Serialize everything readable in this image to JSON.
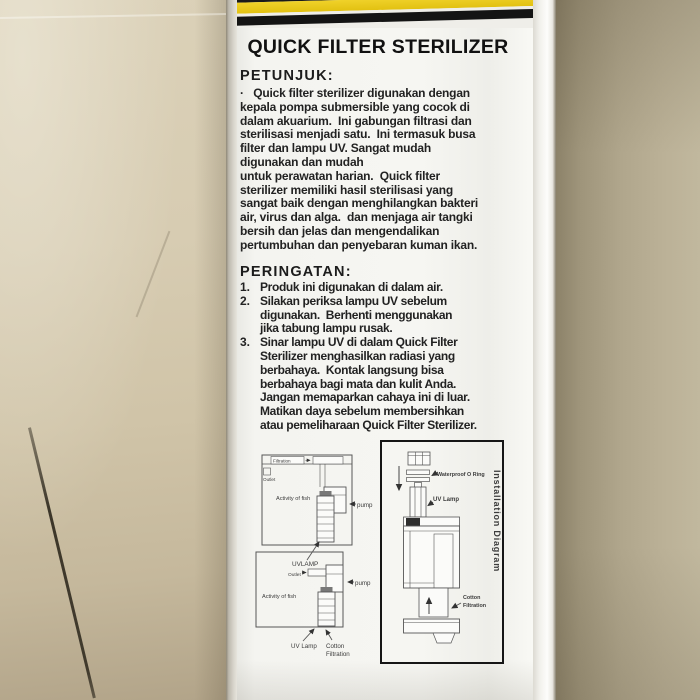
{
  "product": {
    "title": "QUICK FILTER STERILIZER"
  },
  "label": {
    "petunjuk_heading": "PETUNJUK:",
    "petunjuk_body": "·   Quick filter sterilizer digunakan dengan\nkepala pompa submersible yang cocok di\ndalam akuarium.  Ini gabungan filtrasi dan\nsterilisasi menjadi satu.  Ini termasuk busa\nfilter dan lampu UV. Sangat mudah\ndigunakan dan mudah\nuntuk perawatan harian.  Quick filter\nsterilizer memiliki hasil sterilisasi yang\nsangat baik dengan menghilangkan bakteri\nair, virus dan alga.  dan menjaga air tangki\nbersih dan jelas dan mengendalikan\npertumbuhan dan penyebaran kuman ikan.",
    "peringatan_heading": "PERINGATAN:",
    "peringatan_items": [
      {
        "num": "1.",
        "text": "Produk ini digunakan di dalam air."
      },
      {
        "num": "2.",
        "text": "Silakan periksa lampu UV sebelum\ndigunakan.  Berhenti menggunakan\njika tabung lampu rusak."
      },
      {
        "num": "3.",
        "text": "Sinar lampu UV di dalam Quick Filter\nSterilizer menghasilkan radiasi yang\nberbahaya.  Kontak langsung bisa\nberbahaya bagi mata dan kulit Anda.\nJangan memaparkan cahaya ini di luar.\nMatikan daya sebelum membersihkan\natau pemeliharaan Quick Filter Sterilizer."
      }
    ]
  },
  "diagrams": {
    "aquarium_top": {
      "filtration": "Filtration",
      "outlet": "Outlet",
      "activity": "Activity of fish",
      "pump": "pump",
      "uvlamp": "UVLAMP"
    },
    "aquarium_bottom": {
      "outlet": "Outlet",
      "pump": "pump",
      "activity": "Activity of fish",
      "uv_lamp": "UV Lamp",
      "cotton_1": "Cotton",
      "cotton_2": "Filtration"
    },
    "installation": {
      "title": "Installation Diagram",
      "oring": "Waterproof O Ring",
      "uv_lamp": "UV Lamp",
      "cotton_1": "Cotton",
      "cotton_2": "Filtration"
    }
  },
  "colors": {
    "band_yellow": "#e5c515",
    "band_black": "#141414",
    "label_white": "#f5f5f1",
    "text_black": "#222222",
    "floor_tan": "#cfc3a6"
  }
}
